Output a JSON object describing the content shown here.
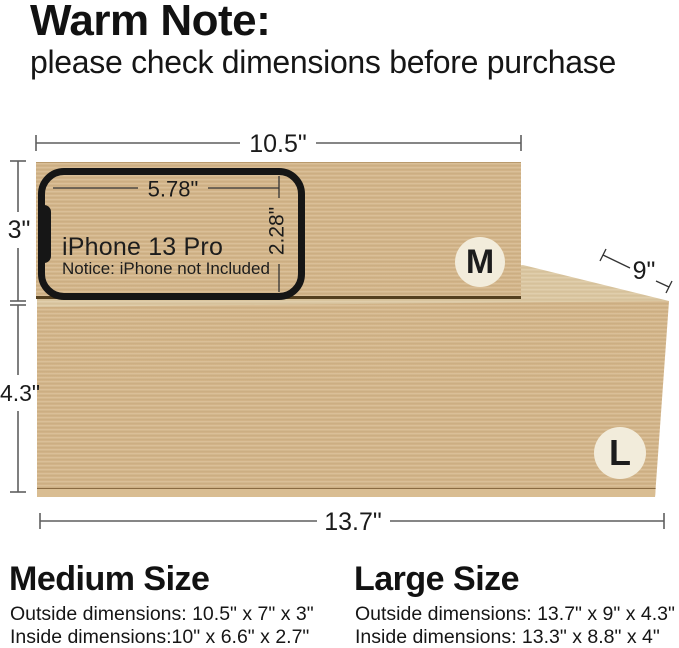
{
  "header": {
    "title": "Warm Note:",
    "subtitle": "please check dimensions before purchase"
  },
  "diagram": {
    "medium_box": {
      "badge": "M",
      "width_label": "10.5\"",
      "height_label": "3\""
    },
    "large_box": {
      "badge": "L",
      "width_label": "13.7\"",
      "height_label": "4.3\"",
      "depth_label": "9\""
    },
    "phone": {
      "model": "iPhone 13 Pro",
      "notice": "Notice: iPhone not Included",
      "width_label": "5.78\"",
      "height_label": "2.28\""
    },
    "colors": {
      "box_face": "#d6b88c",
      "box_top_face": "#ddc9a3",
      "badge_bg": "#f2ecdb",
      "phone_outline": "#161616",
      "dimension_line": "#5f5f5f"
    }
  },
  "footer": {
    "medium": {
      "heading": "Medium Size",
      "outside": "Outside dimensions: 10.5\" x 7\" x 3\"",
      "inside": "Inside dimensions:10\" x 6.6\" x 2.7\""
    },
    "large": {
      "heading": "Large Size",
      "outside": "Outside dimensions: 13.7\" x 9\" x 4.3\"",
      "inside": "Inside dimensions: 13.3\" x 8.8\" x 4\""
    }
  }
}
